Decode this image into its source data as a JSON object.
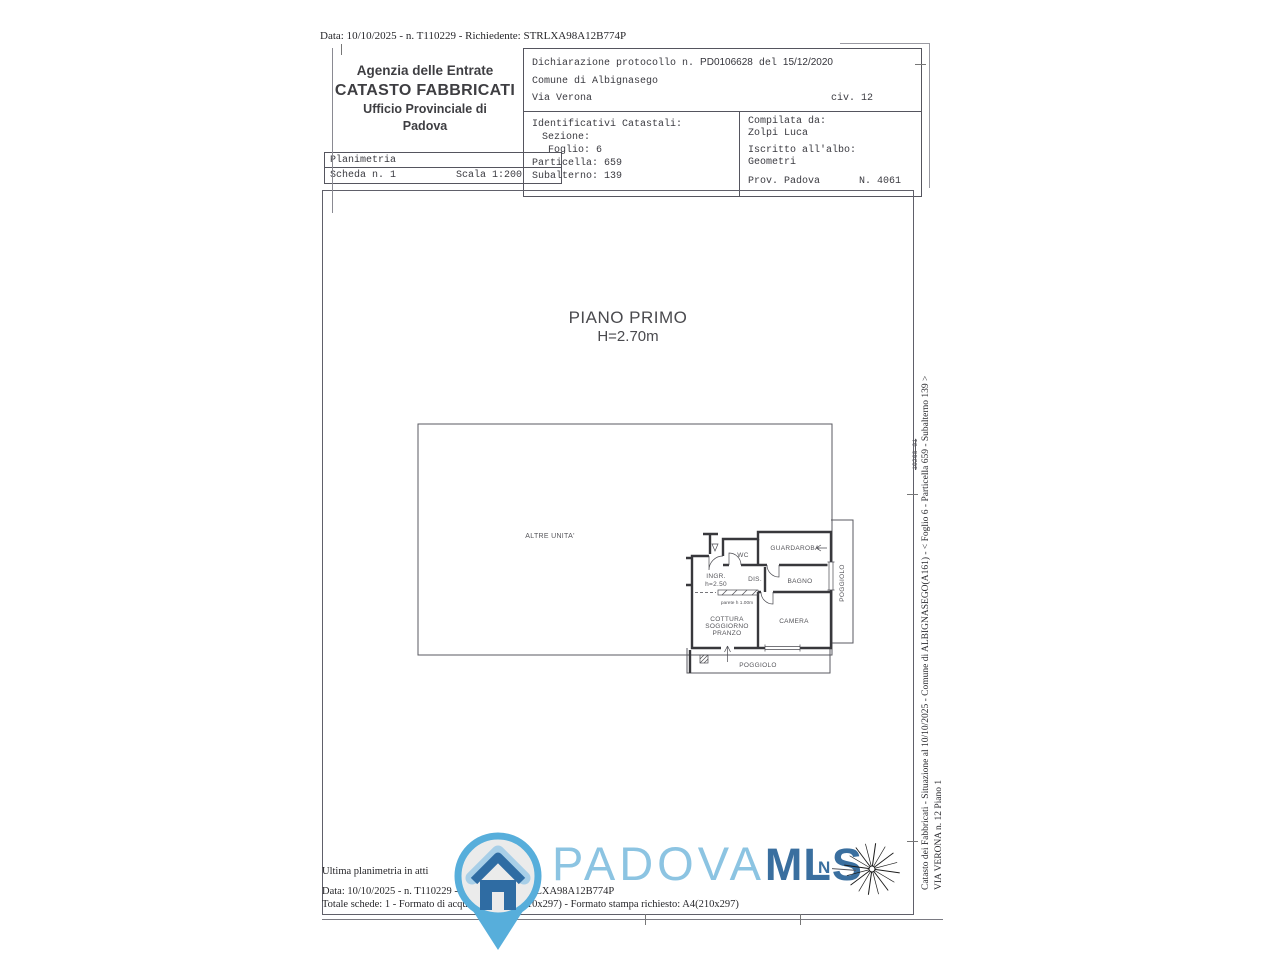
{
  "meta": {
    "top_line": "Data: 10/10/2025 - n. T110229 - Richiedente: STRLXA98A12B774P"
  },
  "header": {
    "agency": {
      "line1": "Agenzia delle Entrate",
      "line2": "CATASTO FABBRICATI",
      "line3": "Ufficio Provinciale di",
      "line4": "Padova"
    },
    "planimetria": {
      "title": "Planimetria",
      "scheda": "Scheda n. 1",
      "scala": "Scala 1:200"
    },
    "declaration": {
      "label": "Dichiarazione protocollo n.",
      "protocol": "PD0106628",
      "del": "del",
      "date": "15/12/2020",
      "comune": "Comune di Albignasego",
      "via": "Via Verona",
      "civ": "civ. 12"
    },
    "identifiers": {
      "title": "Identificativi Catastali:",
      "sezione": "Sezione:",
      "foglio": "Foglio: 6",
      "particella": "Particella: 659",
      "subalterno": "Subalterno: 139"
    },
    "compiler": {
      "label": "Compilata da:",
      "name": "Zolpi Luca",
      "albo_label": "Iscritto all'albo:",
      "albo": "Geometri",
      "prov": "Prov. Padova",
      "num": "N. 4061"
    }
  },
  "plan": {
    "floor_title": "PIANO PRIMO",
    "floor_height": "H=2.70m",
    "rooms": {
      "altre_unita": "ALTRE UNITA'",
      "wc": "WC",
      "guardaroba": "GUARDAROBA",
      "ingr": "INGR.",
      "ingr_h": "h=2.50",
      "dis": "DIS.",
      "bagno": "BAGNO",
      "poggiolo_right": "POGGIOLO",
      "parete": "parete h 1.00m",
      "cottura1": "COTTURA",
      "cottura2": "SOGGIORNO",
      "cottura3": "PRANZO",
      "camera": "CAMERA",
      "poggiolo_bottom": "POGGIOLO"
    }
  },
  "footer": {
    "ultima": "Ultima planimetria in atti",
    "data_line": "Data: 10/10/2025 - n. T110229 - Richiedente: STRLXA98A12B774P",
    "totale": "Totale schede: 1 - Formato di acquisizione: A4(210x297) - Formato stampa richiesto: A4(210x297)"
  },
  "watermark": {
    "brand_light": "PADOVA",
    "brand_bold": "MLS",
    "north_letter": "N"
  },
  "sidebar": {
    "line1": "Catasto dei Fabbricati - Situazione al 10/10/2025 - Comune di ALBIGNASEGO(A161) - <   Foglio 6 - Particella  659 - Subalterno 139 >",
    "line2": "VIA VERONA n. 12 Piano 1",
    "struck_note": "10268-01"
  },
  "colors": {
    "brand_light_blue": "#8cc4e2",
    "brand_dark_blue": "#3a6f9f",
    "pin_blue": "#57aedb",
    "pin_house_blue": "#2f6ca3",
    "ink": "#3a3a40"
  }
}
